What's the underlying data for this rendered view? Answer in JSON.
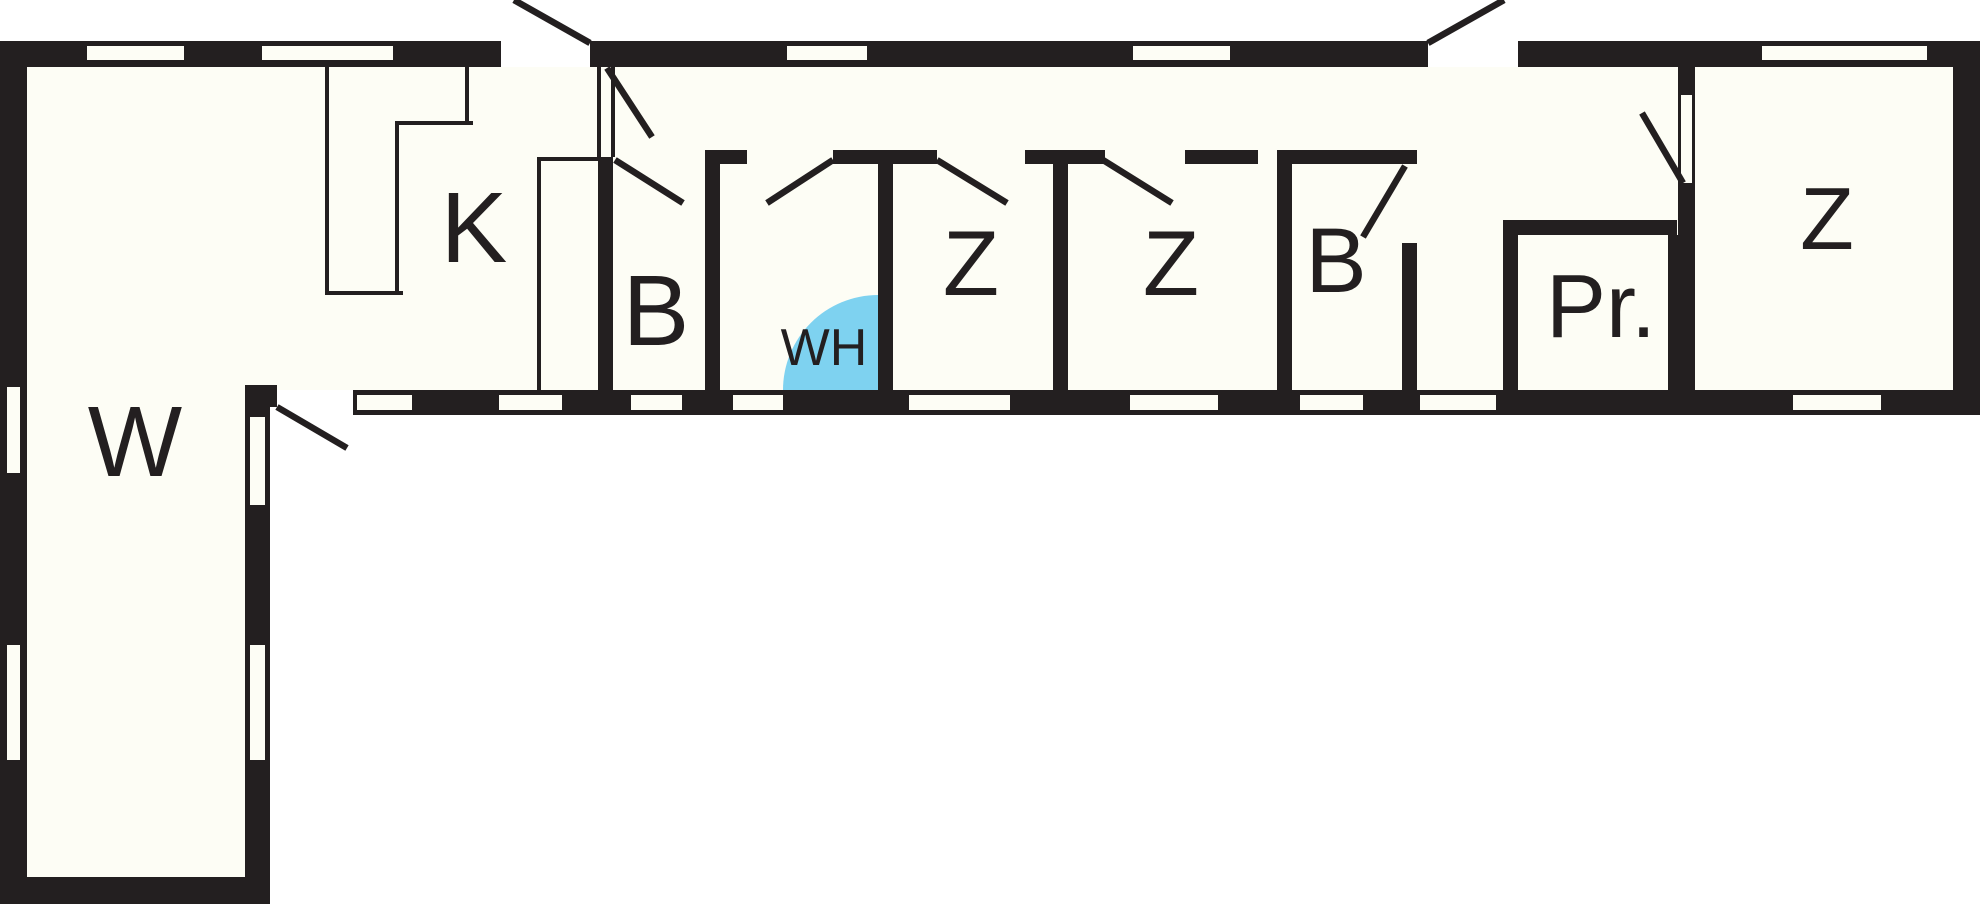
{
  "plan": {
    "type": "floor-plan",
    "background_color": "#ffffff",
    "floor_color": "#fdfdf5",
    "wall_color": "#231f20",
    "highlight_color": "#7ed2f0",
    "label_color": "#231f20",
    "rooms": [
      {
        "id": "living-room",
        "label": "W",
        "cx": 135,
        "cy": 442,
        "font_size": 100
      },
      {
        "id": "kitchen",
        "label": "K",
        "cx": 474,
        "cy": 228,
        "font_size": 100
      },
      {
        "id": "bathroom-1",
        "label": "B",
        "cx": 656,
        "cy": 311,
        "font_size": 100
      },
      {
        "id": "shower-area",
        "label": "WH",
        "cx": 824,
        "cy": 348,
        "font_size": 52
      },
      {
        "id": "bedroom-1",
        "label": "Z",
        "cx": 971,
        "cy": 264,
        "font_size": 92
      },
      {
        "id": "bedroom-2",
        "label": "Z",
        "cx": 1171,
        "cy": 264,
        "font_size": 92
      },
      {
        "id": "bathroom-2",
        "label": "B",
        "cx": 1336,
        "cy": 261,
        "font_size": 92
      },
      {
        "id": "pantry",
        "label": "Pr.",
        "cx": 1601,
        "cy": 307,
        "font_size": 90
      },
      {
        "id": "bedroom-3",
        "label": "Z",
        "cx": 1827,
        "cy": 219,
        "font_size": 88
      }
    ]
  }
}
